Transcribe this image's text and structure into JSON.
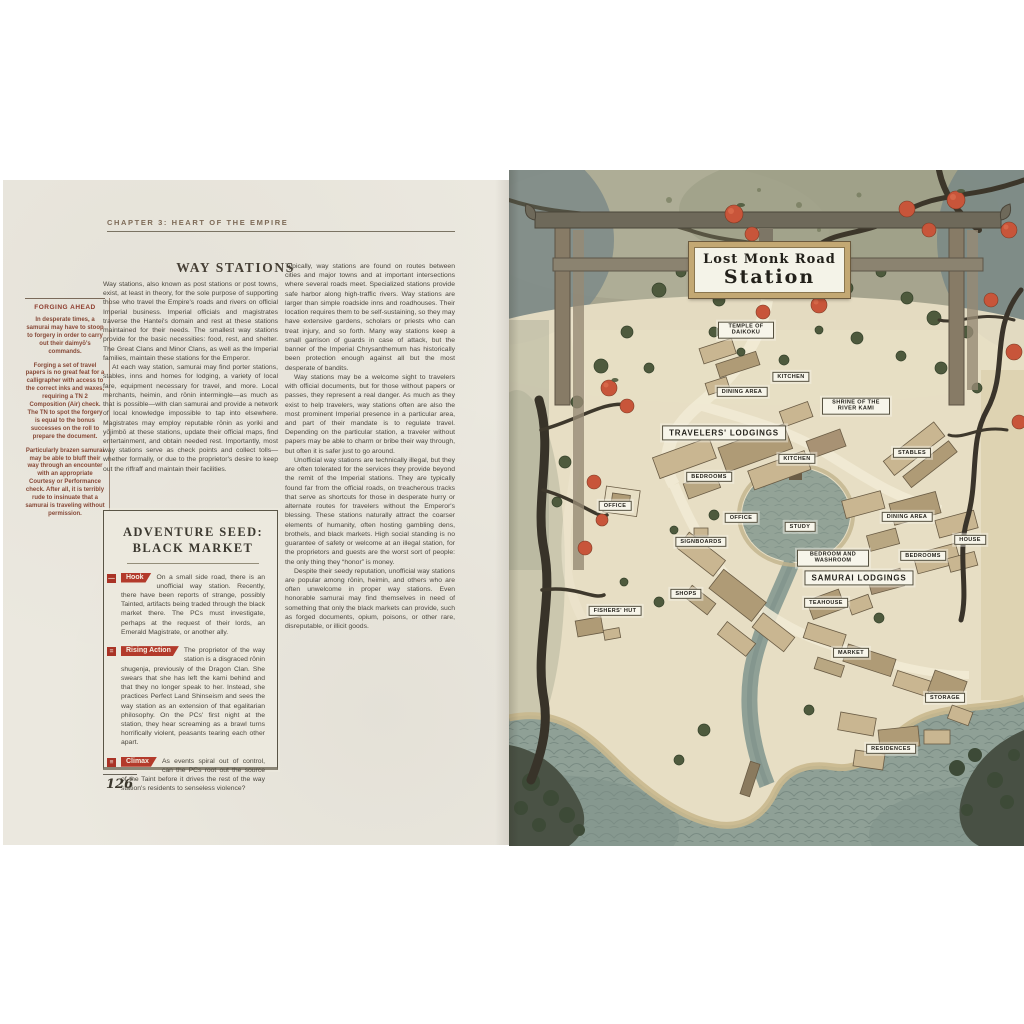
{
  "page_left": {
    "chapter_header": "CHAPTER 3: HEART OF THE EMPIRE",
    "heading": "WAY STATIONS",
    "page_number": "126",
    "sidebar": {
      "title": "FORGING AHEAD",
      "paragraphs": [
        "In desperate times, a samurai may have to stoop to forgery in order to carry out their daimyō's commands.",
        "Forging a set of travel papers is no great feat for a calligrapher with access to the correct inks and waxes, requiring a TN 2 Composition (Air) check. The TN to spot the forgery is equal to the bonus successes on the roll to prepare the document.",
        "Particularly brazen samurai may be able to bluff their way through an encounter with an appropriate Courtesy or Performance check. After all, it is terribly rude to insinuate that a samurai is traveling without permission."
      ]
    },
    "column1_paragraphs": [
      "Way stations, also known as post stations or post towns, exist, at least in theory, for the sole purpose of supporting those who travel the Empire's roads and rivers on official Imperial business. Imperial officials and magistrates traverse the Hantei's domain and rest at these stations maintained for their needs. The smallest way stations provide for the basic necessities: food, rest, and shelter. The Great Clans and Minor Clans, as well as the Imperial families, maintain these stations for the Emperor.",
      "At each way station, samurai may find porter stations, stables, inns and homes for lodging, a variety of local fare, equipment necessary for travel, and more. Local merchants, heimin, and rōnin intermingle—as much as that is possible—with clan samurai and provide a network of local knowledge impossible to tap into elsewhere. Magistrates may employ reputable rōnin as yoriki and yōjimbō at these stations, update their official maps, find entertainment, and obtain needed rest. Importantly, most way stations serve as check points and collect tolls—whether formally, or due to the proprietor's desire to keep out the riffraff and maintain their facilities."
    ],
    "column2_paragraphs": [
      "Typically, way stations are found on routes between cities and major towns and at important intersections where several roads meet. Specialized stations provide safe harbor along high-traffic rivers. Way stations are larger than simple roadside inns and roadhouses. Their location requires them to be self-sustaining, so they may have extensive gardens, scholars or priests who can treat injury, and so forth. Many way stations keep a small garrison of guards in case of attack, but the banner of the Imperial Chrysanthemum has historically been protection enough against all but the most desperate of bandits.",
      "Way stations may be a welcome sight to travelers with official documents, but for those without papers or passes, they represent a real danger. As much as they exist to help travelers, way stations often are also the most prominent Imperial presence in a particular area, and part of their mandate is to regulate travel. Depending on the particular station, a traveler without papers may be able to charm or bribe their way through, but often it is safer just to go around.",
      "Unofficial way stations are technically illegal, but they are often tolerated for the services they provide beyond the remit of the Imperial stations. They are typically found far from the official roads, on treacherous tracks that serve as shortcuts for those in desperate hurry or alternate routes for travelers without the Emperor's blessing. These stations naturally attract the coarser elements of humanity, often hosting gambling dens, brothels, and black markets. High social standing is no guarantee of safety or welcome at an illegal station, for the proprietors and guests are the worst sort of people: the only thing they “honor” is money.",
      "Despite their seedy reputation, unofficial way stations are popular among rōnin, heimin, and others who are often unwelcome in proper way stations. Even honorable samurai may find themselves in need of something that only the black markets can provide, such as forged documents, opium, poisons, or other rare, disreputable, or illicit goods."
    ],
    "adventure_seed": {
      "title_line1": "ADVENTURE SEED:",
      "title_line2": "BLACK MARKET",
      "sections": [
        {
          "icon_glyph": "—",
          "label": "Hook",
          "text": "On a small side road, there is an unofficial way station. Recently, there have been reports of strange, possibly Tainted, artifacts being traded through the black market there. The PCs must investigate, perhaps at the request of their lords, an Emerald Magistrate, or another ally."
        },
        {
          "icon_glyph": "=",
          "label": "Rising Action",
          "text": "The proprietor of the way station is a disgraced rōnin shugenja, previously of the Dragon Clan. She swears that she has left the kami behind and that they no longer speak to her. Instead, she practices Perfect Land Shinseism and sees the way station as an extension of that egalitarian philosophy. On the PCs' first night at the station, they hear screaming as a brawl turns horrifically violent, peasants tearing each other apart."
        },
        {
          "icon_glyph": "≡",
          "label": "Climax",
          "text": "As events spiral out of control, can the PCs root out the source of the Taint before it drives the rest of the way station's residents to senseless violence?"
        }
      ]
    }
  },
  "page_right": {
    "sign_line1": "Lost Monk Road",
    "sign_line2": "Station",
    "map_labels": [
      {
        "text": "TEMPLE OF DAIKOKU",
        "x": 237,
        "y": 160,
        "w": 46
      },
      {
        "text": "KITCHEN",
        "x": 282,
        "y": 207
      },
      {
        "text": "DINING AREA",
        "x": 233,
        "y": 222
      },
      {
        "text": "SHRINE OF THE RIVER KAMI",
        "x": 347,
        "y": 236,
        "w": 58
      },
      {
        "text": "TRAVELERS' LODGINGS",
        "x": 215,
        "y": 263,
        "large": true
      },
      {
        "text": "KITCHEN",
        "x": 288,
        "y": 289
      },
      {
        "text": "BEDROOMS",
        "x": 200,
        "y": 307
      },
      {
        "text": "STABLES",
        "x": 403,
        "y": 283
      },
      {
        "text": "OFFICE",
        "x": 106,
        "y": 336
      },
      {
        "text": "OFFICE",
        "x": 232,
        "y": 348
      },
      {
        "text": "STUDY",
        "x": 291,
        "y": 357
      },
      {
        "text": "DINING AREA",
        "x": 398,
        "y": 347
      },
      {
        "text": "SIGNBOARDS",
        "x": 192,
        "y": 372
      },
      {
        "text": "HOUSE",
        "x": 461,
        "y": 370
      },
      {
        "text": "BEDROOM AND WASHROOM",
        "x": 324,
        "y": 388,
        "w": 62
      },
      {
        "text": "BEDROOMS",
        "x": 414,
        "y": 386
      },
      {
        "text": "SAMURAI LODGINGS",
        "x": 350,
        "y": 408,
        "large": true
      },
      {
        "text": "SHOPS",
        "x": 177,
        "y": 424
      },
      {
        "text": "FISHERS' HUT",
        "x": 106,
        "y": 441
      },
      {
        "text": "TEAHOUSE",
        "x": 317,
        "y": 433
      },
      {
        "text": "MARKET",
        "x": 342,
        "y": 483
      },
      {
        "text": "STORAGE",
        "x": 436,
        "y": 528
      },
      {
        "text": "RESIDENCES",
        "x": 382,
        "y": 579
      }
    ]
  },
  "colors": {
    "accent_red": "#b33a2b",
    "sidebar_maroon": "#8d3b2c",
    "persimmon_orange": "#c8553a",
    "water_green": "#8fa096",
    "page_paper": "#ebe8df",
    "map_ground": "#e7dec4"
  }
}
